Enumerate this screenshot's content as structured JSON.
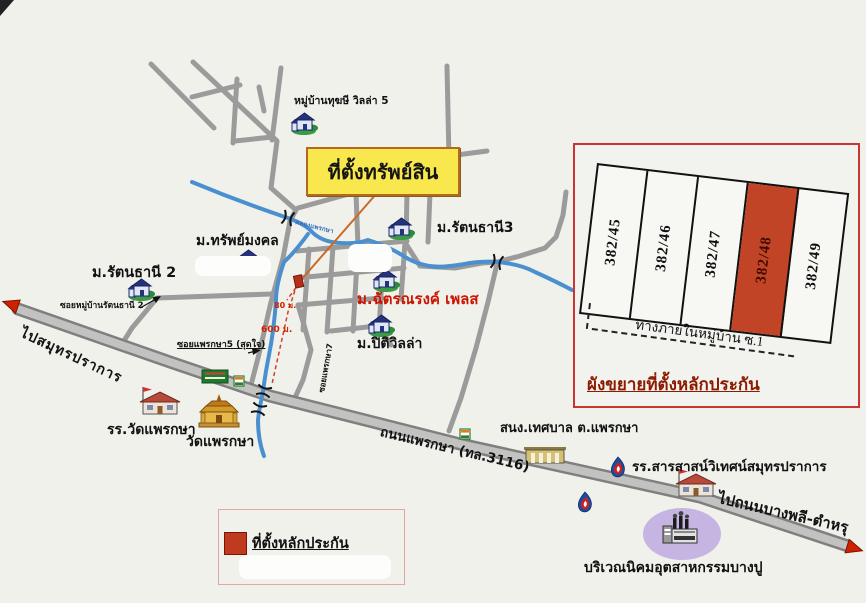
{
  "banner": {
    "title": "ที่ตั้งทรัพย์สิน"
  },
  "labels": {
    "village_villa5": "หมู่บ้านทุฆษี วิลล่า 5",
    "m_sap_mongkol": "ม.ทรัพย์มงคล",
    "m_rattanathani2": "ม.รัตนธานี 2",
    "soi_rattanathani2": "ซอยหมู่บ้านรัตนธานี 2",
    "m_rattanathani3": "ม.รัตนธานี3",
    "m_chatnarong_place": "ม.ฉัตรณรงค์ เพลส",
    "m_piti_villa": "ม.ปิติวิลล่า",
    "soi_phraeksa5": "ซอยแพรกษา5 (สุดใจ)",
    "soi_phraeksa7": "ซอยแพรกษา7",
    "khlong_phraeksa": "คลองแพรกษา",
    "dist_80m": "80 ม.",
    "dist_600m": "600 ม.",
    "to_samut_prakan": "ไปสมุทรปราการ",
    "phraeksa_road": "ถนนแพรกษา (ทล.3116)",
    "municipal_office": "สนง.เทศบาล ต.แพรกษา",
    "wat_phraeksa_school": "รร.วัดแพรกษา",
    "wat_phraeksa": "วัดแพรกษา",
    "sarasas_school": "รร.สารสาสน์วิเทศน์สมุทรปราการ",
    "to_bang_phli": "ไปถนนบางพลี-ตำหรุ",
    "bang_pu_industrial": "บริเวณนิคมอุตสาหกรรมบางปู"
  },
  "inset": {
    "plots": [
      "382/45",
      "382/46",
      "382/47",
      "382/48",
      "382/49"
    ],
    "highlighted_plot": "382/48",
    "road_label": "ทางภายในหมู่บ้าน ซ.1",
    "caption": "ผังขยายที่ตั้งหลักประกัน"
  },
  "legend": {
    "item": "ที่ตั้งหลักประกัน"
  },
  "icons": [
    "house-icon",
    "temple-icon",
    "school-icon",
    "municipal-building-icon",
    "gas-station-icon",
    "factory-icon",
    "convenience-store-icon",
    "green-sign-icon",
    "bridge-icon",
    "road-arrow-icon",
    "property-marker",
    "poi-circle-marker"
  ],
  "colors": {
    "paper": "#f1f1ec",
    "road_gray": "#9b9b9b",
    "canal_blue": "#4a90d0",
    "banner_yellow": "#f8e84e",
    "highlight_red": "#c04425",
    "inset_border": "#cc3333",
    "caption_red": "#8b1c00",
    "industrial_purple": "#c6b5e2"
  }
}
